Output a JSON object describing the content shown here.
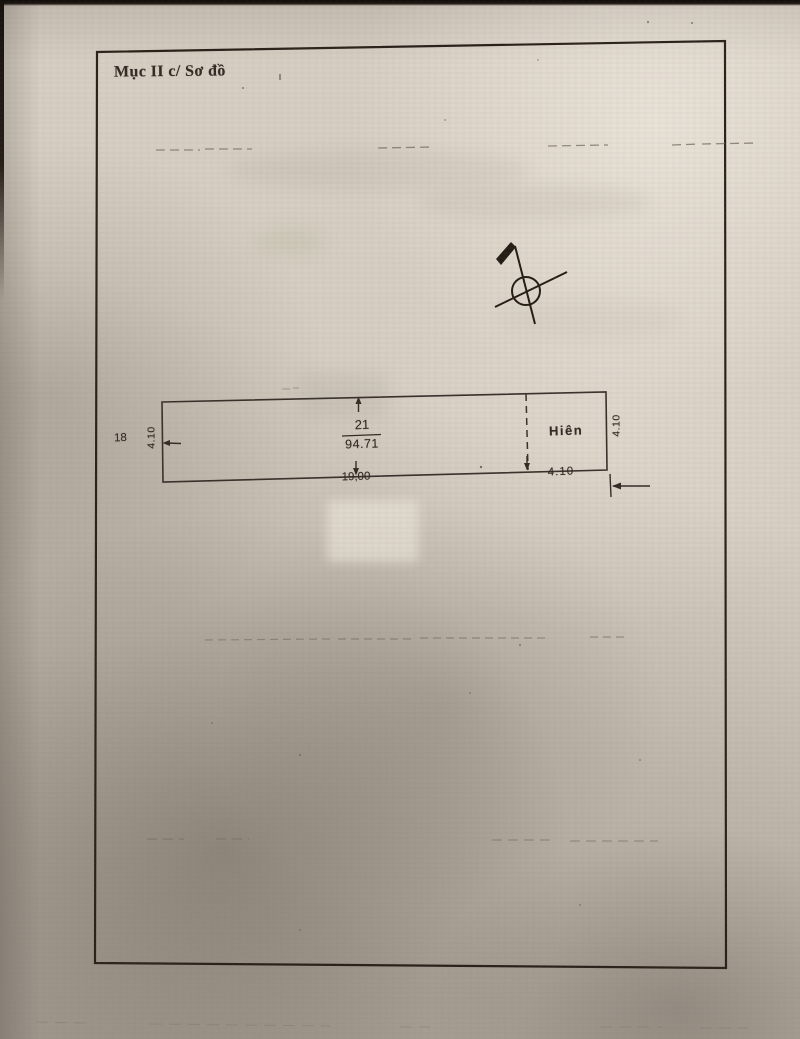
{
  "page": {
    "title": "Mục II c/ Sơ đồ"
  },
  "sketch": {
    "parcel": {
      "number": "21",
      "area": "94.71"
    },
    "porch": {
      "label": "Hiên"
    },
    "neighbor": {
      "label": "18"
    },
    "dimensions": {
      "left_width": "4.10",
      "right_width": "4.10",
      "bottom_length": "19,00",
      "bottom_porch_width": "4.10"
    },
    "icons": {
      "north_arrow": "surveyor-north-arrow"
    }
  },
  "colors": {
    "paper": "#d7cec3",
    "ink": "#2e2720",
    "border": "#2a211a",
    "shadow": "#9d9388"
  }
}
